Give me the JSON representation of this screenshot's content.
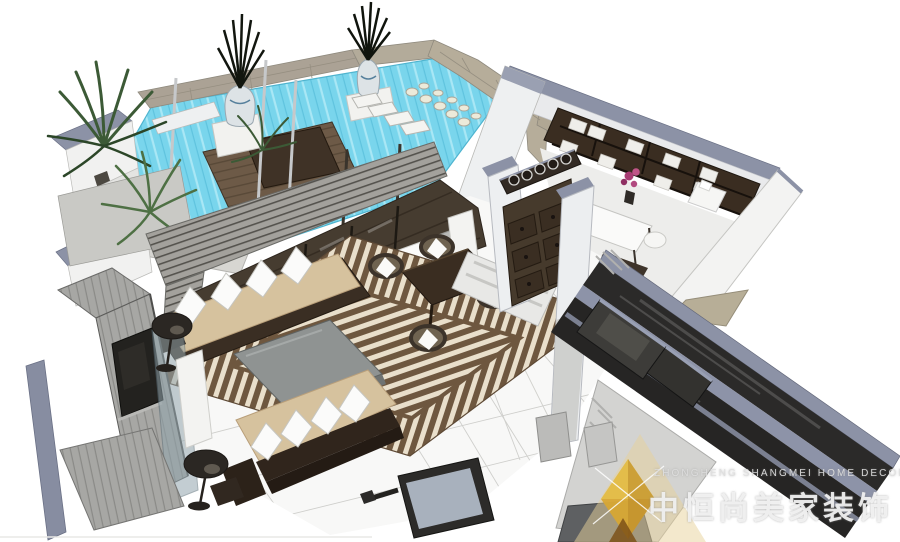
{
  "watermark": {
    "company_en": "ZHONGHENG SHANGMEI HOME DECORATION",
    "company_cn": "中恒尚美家装饰",
    "logo": "gold-diamond"
  },
  "palette": {
    "pool_water": "#79d5ec",
    "pool_water_light": "#a9e7f5",
    "rug_brown": "#6e573f",
    "rug_cream": "#e9dfcb",
    "sofa_tan": "#d6c29e",
    "wall_white": "#f1f1f0",
    "wall_cap_slate": "#8c92a6",
    "stone_tan": "#aba295",
    "dark_wood": "#3a2d21",
    "canopy_gray": "#a3a19c",
    "glass_dark": "#2b2a29",
    "plant_green": "#47663f",
    "logo_gold": "#e3bc45"
  }
}
